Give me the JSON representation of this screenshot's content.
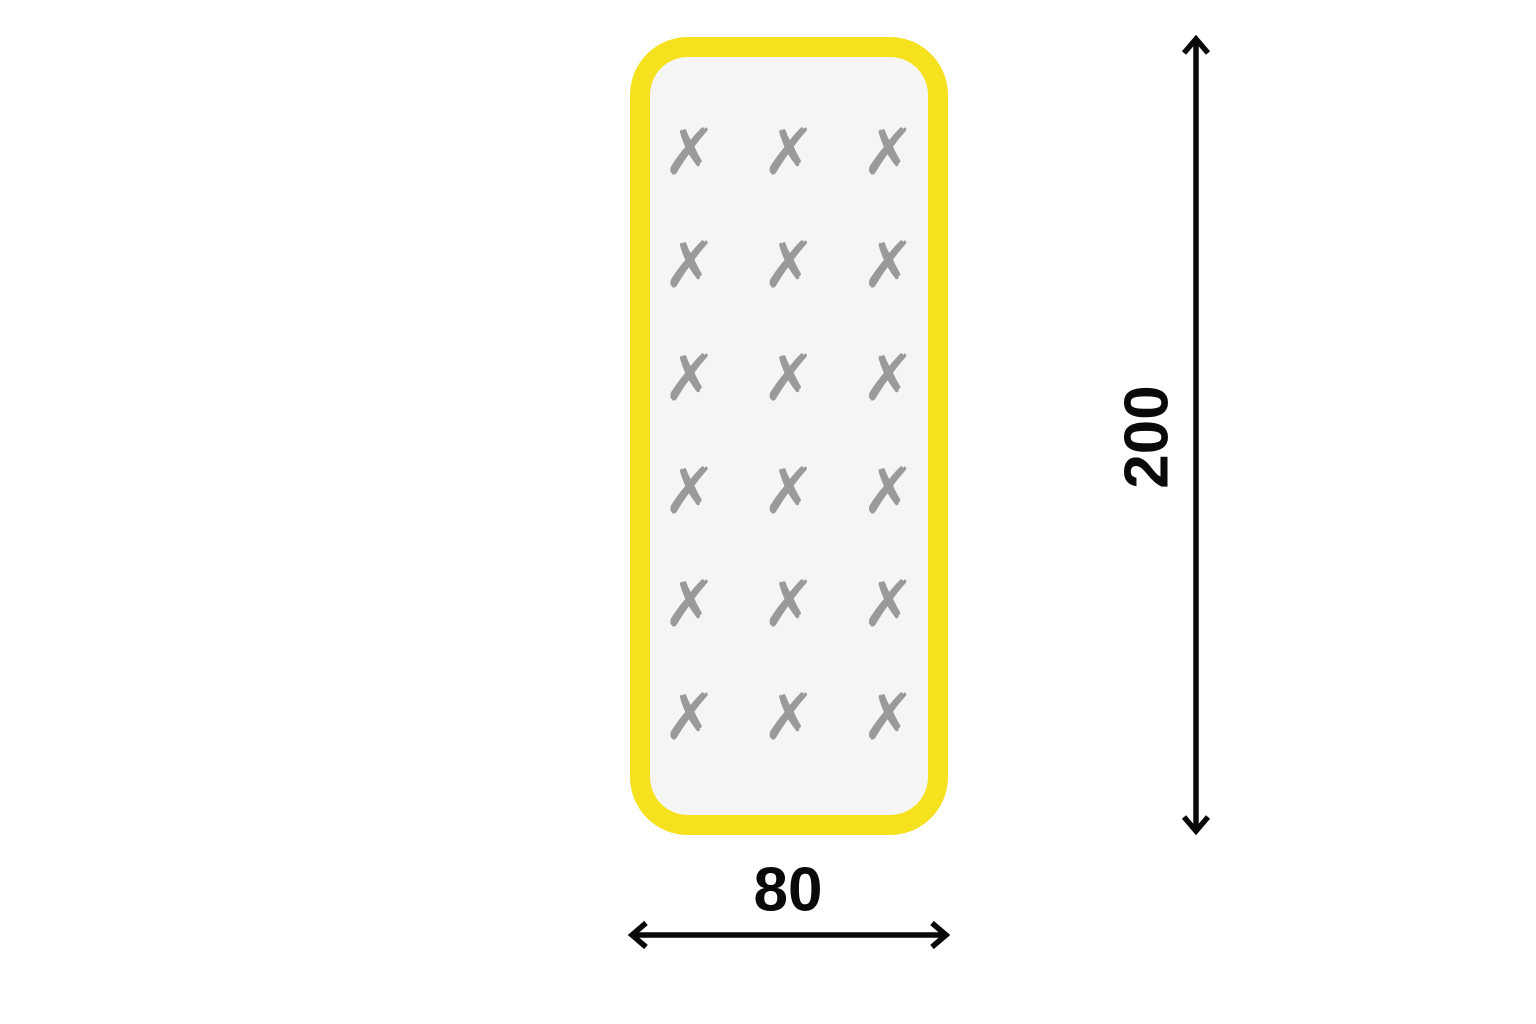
{
  "diagram": {
    "mat": {
      "grid": {
        "rows": 6,
        "cols": 3,
        "symbol": "✗",
        "symbol_name": "cross-mark"
      },
      "colors": {
        "outline": "#F5E11E",
        "surface": "#F5F5F5",
        "marks": "#9A9A9A"
      }
    },
    "dimensions": {
      "height_label": "200",
      "width_label": "80",
      "line_color": "#0A0A0A"
    }
  }
}
